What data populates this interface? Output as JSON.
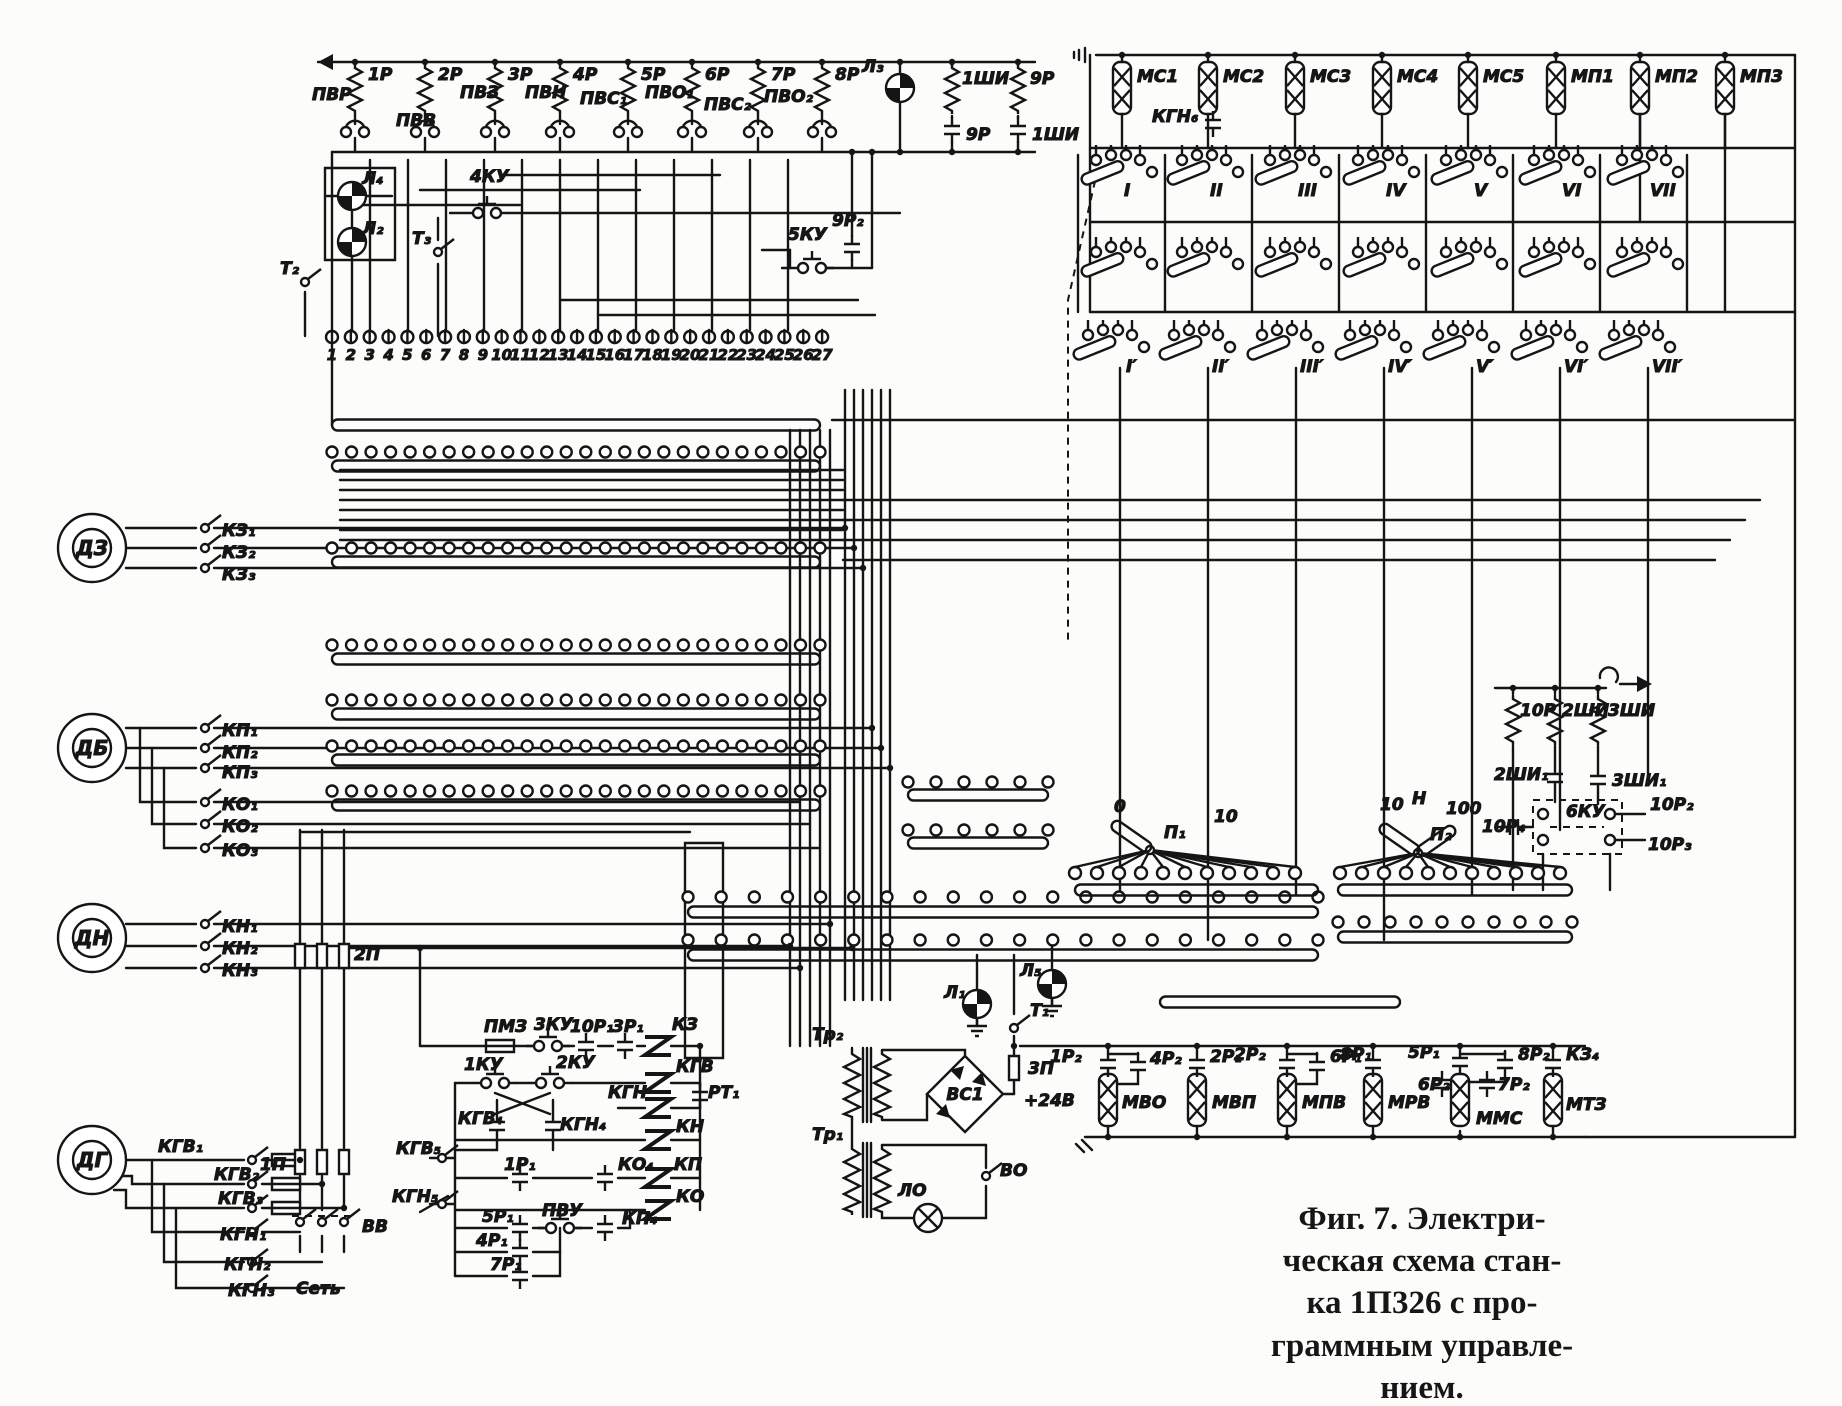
{
  "figure": {
    "caption_lines": [
      "Фиг. 7. Электри-",
      "ческая схема стан-",
      "ка 1П326 с про-",
      "граммным управле-",
      "нием."
    ]
  },
  "terminals": [
    "1",
    "2",
    "3",
    "4",
    "5",
    "6",
    "7",
    "8",
    "9",
    "10",
    "11",
    "12",
    "13",
    "14",
    "15",
    "16",
    "17",
    "18",
    "19",
    "20",
    "21",
    "22",
    "23",
    "24",
    "25",
    "26",
    "27"
  ],
  "colors": {
    "ink": "#151515",
    "paper": "#fcfcfa"
  },
  "labels": {
    "r1": "1Р",
    "r2": "2Р",
    "r3": "3Р",
    "r4": "4Р",
    "r5": "5Р",
    "r6": "6Р",
    "r7": "7Р",
    "r8": "8Р",
    "r9": "9Р",
    "shi1": "1ШИ",
    "c9r": "9Р",
    "c1shi": "1ШИ",
    "pvr": "ПВР",
    "pvv": "ПВВ",
    "pvz": "ПВЗ",
    "pvn": "ПВН",
    "pvs1": "ПВС₁",
    "pvo1": "ПВО₁",
    "pvs2": "ПВС₂",
    "pvo2": "ПВО₂",
    "l1": "Л₁",
    "l2": "Л₂",
    "l3": "Л₃",
    "l4": "Л₄",
    "l5": "Л₅",
    "t1": "Т₁",
    "t2": "Т₂",
    "t3": "Т₃",
    "ku1": "1КУ",
    "ku2": "2КУ",
    "ku3": "3КУ",
    "ku4": "4КУ",
    "ku5": "5КУ",
    "ku6": "6КУ",
    "r9_2": "9Р₂",
    "ms1": "МС1",
    "ms2": "МС2",
    "ms3": "МС3",
    "ms4": "МС4",
    "ms5": "МС5",
    "mp1": "МП1",
    "mp2": "МП2",
    "mp3": "МП3",
    "kgn6": "КГН₆",
    "b1": "I",
    "b2": "II",
    "b3": "III",
    "b4": "IV",
    "b5": "V",
    "b6": "VI",
    "b7": "VII",
    "b1p": "I′",
    "b2p": "II′",
    "b3p": "III′",
    "b4p": "IV′",
    "b5p": "V′",
    "b6p": "VI′",
    "b7p": "VII′",
    "dz": "ДЗ",
    "db": "ДБ",
    "dn": "ДН",
    "dg": "ДГ",
    "kz1": "КЗ₁",
    "kz2": "КЗ₂",
    "kz3": "КЗ₃",
    "kp1": "КП₁",
    "kp2": "КП₂",
    "kp3": "КП₃",
    "ko1": "КО₁",
    "ko2": "КО₂",
    "ko3": "КО₃",
    "kn1": "КН₁",
    "kn2": "КН₂",
    "kn3": "КН₃",
    "kgv1": "КГВ₁",
    "kgv2": "КГВ₂",
    "kgv3": "КГВ₃",
    "kgn1": "КГН₁",
    "kgn2": "КГН₂",
    "kgn3": "КГН₃",
    "p1f": "1П",
    "p2f": "2П",
    "p3f": "3П",
    "vv": "ВВ",
    "set": "Сеть",
    "r10": "10Р",
    "shi2": "2ШИ",
    "shi3": "3ШИ",
    "shi2_1": "2ШИ₁",
    "shi3_1": "3ШИ₁",
    "r10_1": "10Р₁",
    "r10_2": "10Р₂",
    "r10_3": "10Р₃",
    "r10_4": "10Р₄",
    "pi1": "П₁",
    "pi2": "П₂",
    "z0": "0",
    "z10a": "10",
    "z10b": "10",
    "zH": "Н",
    "z100": "100",
    "pmz": "ПМЗ",
    "r3_1": "3Р₁",
    "kz": "КЗ",
    "kgv": "КГВ",
    "kgn": "КГН",
    "rt1": "РТ₁",
    "kn": "КН",
    "kp": "КП",
    "ko": "КО",
    "kgv4": "КГВ₄",
    "kgn4": "КГН₄",
    "kgv5": "КГВ₅",
    "kgn5": "КГН₅",
    "r1_1": "1Р₁",
    "ko4": "КО₄",
    "kp4": "КП₄",
    "pvu": "ПВУ",
    "r5_1": "5Р₁",
    "r4_1": "4Р₁",
    "r7_1": "7Р₁",
    "tr1": "Тр₁",
    "tr2": "Тр₂",
    "vs1": "ВС1",
    "v24": "+24В",
    "lo": "ЛО",
    "vo": "ВО",
    "r1_2": "1Р₂",
    "r4_2": "4Р₂",
    "mvo": "МВО",
    "r2_1": "2Р₁",
    "r2_2": "2Р₂",
    "r6_1": "6Р₁",
    "mvp": "МВП",
    "mpv": "МПВ",
    "r8_1": "8Р₁",
    "mrv": "МРВ",
    "r5_1b": "5Р₁",
    "r6_2": "6Р₂",
    "r7_2": "7Р₂",
    "mms": "ММС",
    "r8_2": "8Р₂",
    "kz4": "КЗ₄",
    "mtz": "МТЗ"
  }
}
